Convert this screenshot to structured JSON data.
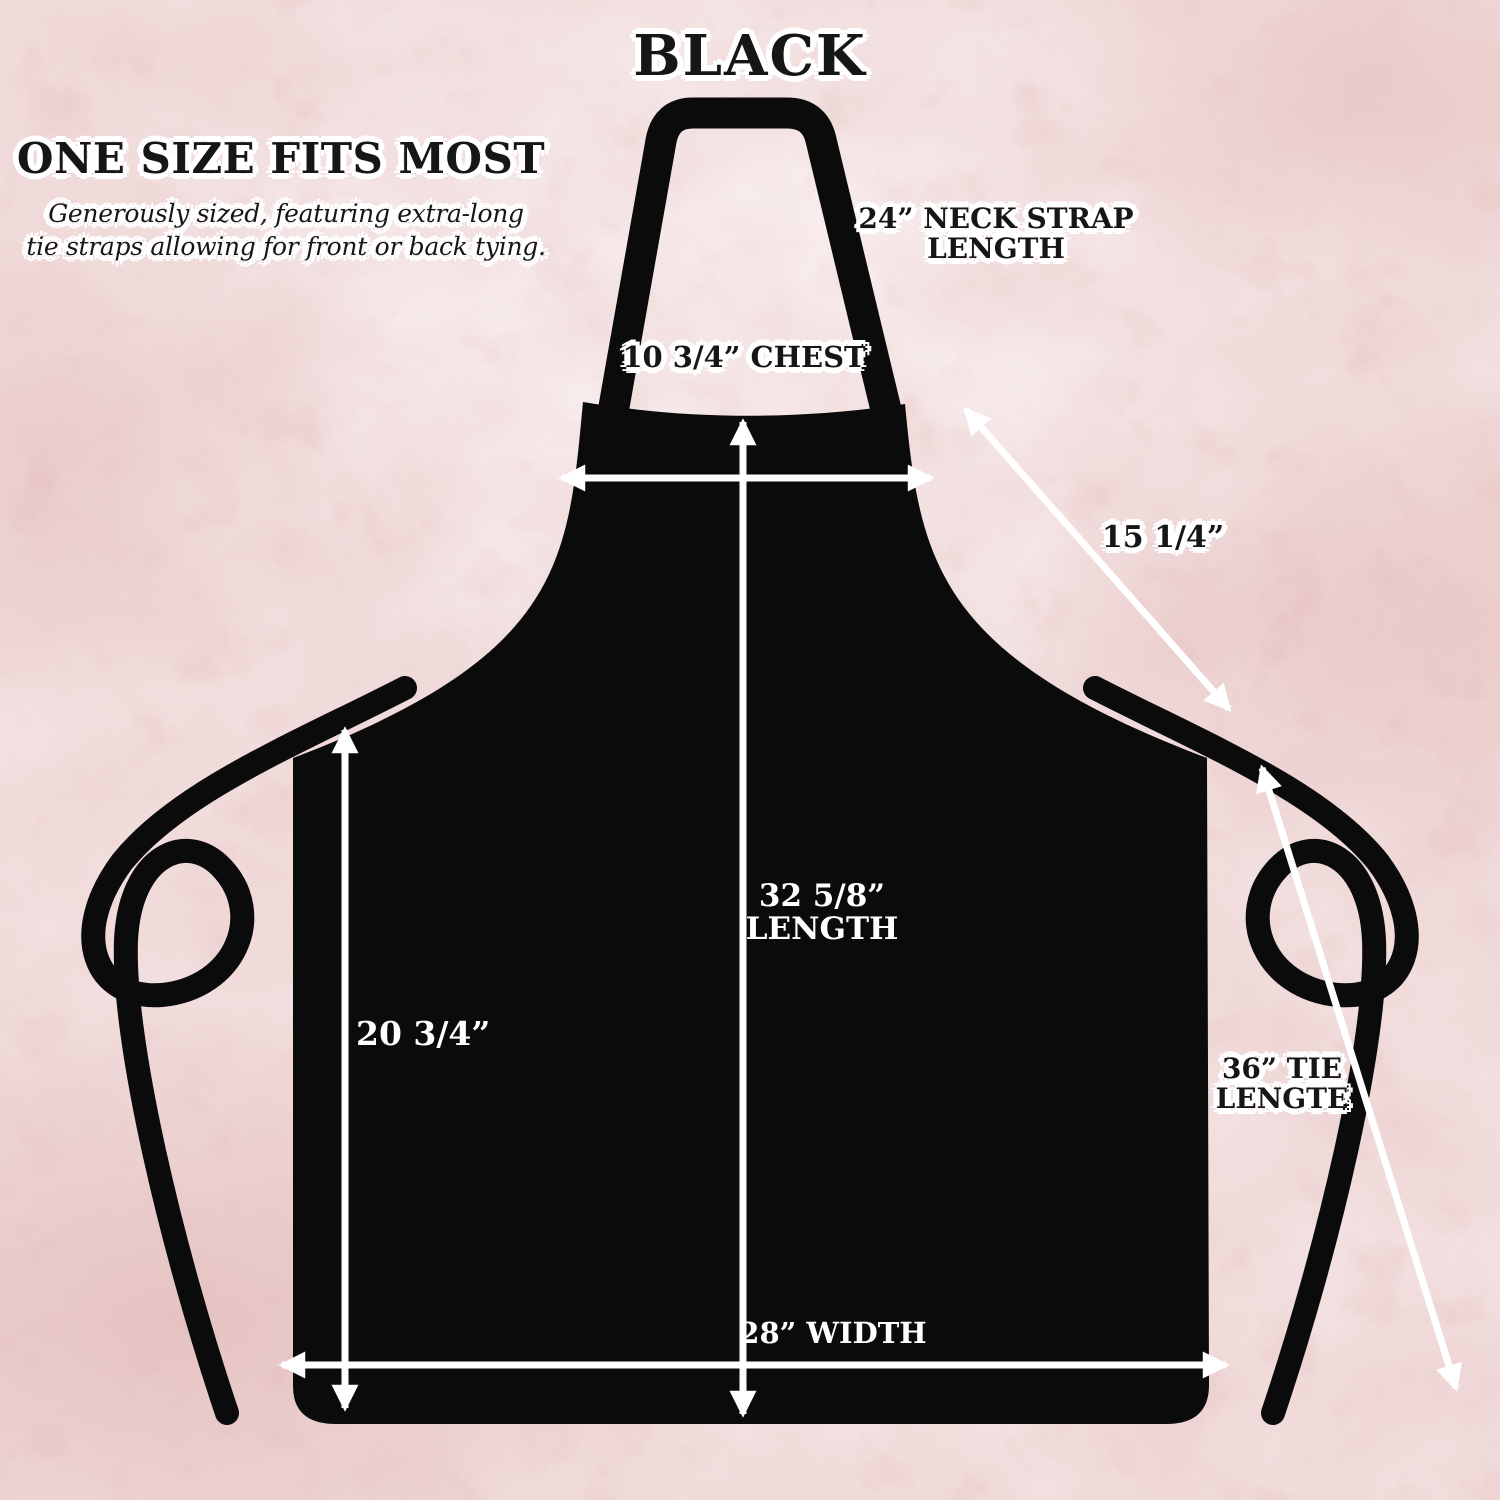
{
  "title": "BLACK",
  "size_info": {
    "heading": "ONE SIZE FITS MOST",
    "subtitle_line1": "Generously sized, featuring extra-long",
    "subtitle_line2": "tie straps allowing for front or back tying."
  },
  "measurements": {
    "neck_strap_line1": "24” NECK STRAP",
    "neck_strap_line2": "LENGTH",
    "chest": "10 3/4” CHEST",
    "neck_strap_diagonal": "15 1/4”",
    "length_line1": "32 5/8”",
    "length_line2": "LENGTH",
    "side_length": "20 3/4”",
    "tie_line1": "36” TIE",
    "tie_line2": "LENGTE",
    "width": "28” WIDTH"
  },
  "colors": {
    "apron_black": "#0b0b0b",
    "arrow_white": "#ffffff",
    "label_dark": "#161616",
    "label_halo": "#ffffff",
    "label_light": "#ffffff",
    "marble_base": "#f3e1e1",
    "marble_mottle": "#cc8f8f",
    "marble_vein": "#a64f48"
  }
}
